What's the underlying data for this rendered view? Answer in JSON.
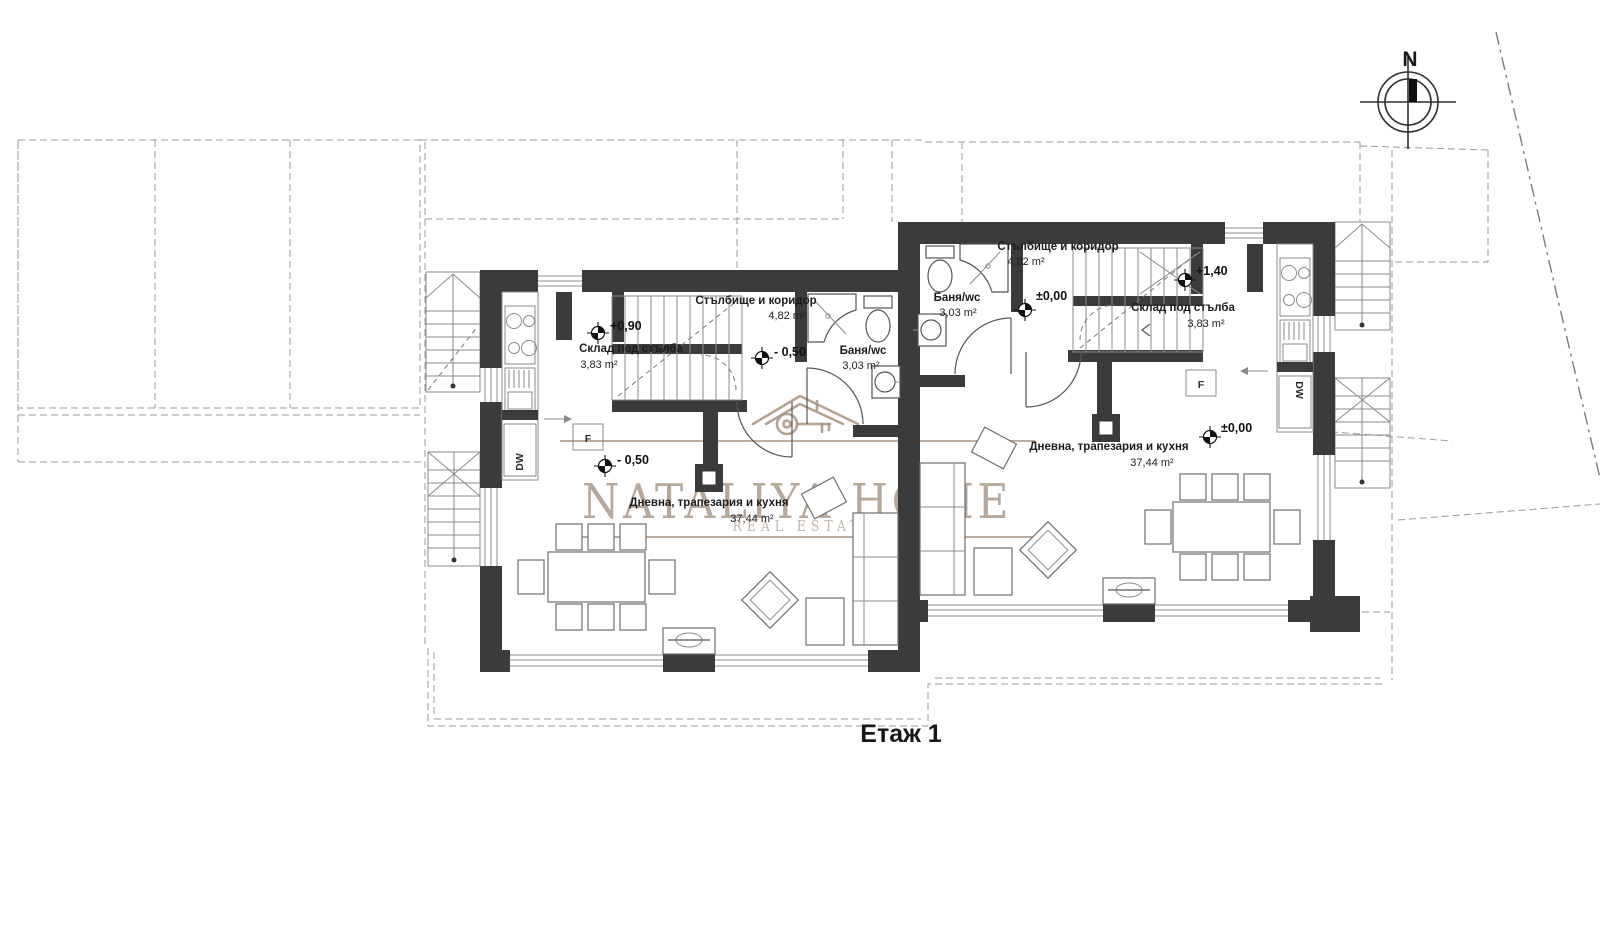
{
  "title": "Етаж 1",
  "compass": {
    "north_label": "N"
  },
  "watermark": {
    "brand": "NATALIYA HOME",
    "tagline": "REAL ESTATE"
  },
  "colors": {
    "wall": "#3b3b3b",
    "watermark": "#b3a597",
    "background": "#ffffff"
  },
  "unit_left": {
    "corridor": {
      "name": "Стълбище и коридор",
      "area": "4,82 m²"
    },
    "storage": {
      "name": "Склад под стълба",
      "area": "3,83 m²"
    },
    "bathroom": {
      "name": "Баня/wc",
      "area": "3,03 m²"
    },
    "living": {
      "name": "Дневна, трапезария и кухня",
      "area": "37,44 m²"
    },
    "levels": {
      "entry": "+0,90",
      "corridor": "- 0,50",
      "living": "- 0,50"
    },
    "appliances": {
      "dishwasher": "DW",
      "fridge": "F"
    }
  },
  "unit_right": {
    "corridor": {
      "name": "Стълбище и коридор",
      "area": "4,82 m²"
    },
    "storage": {
      "name": "Склад под стълба",
      "area": "3,83 m²"
    },
    "bathroom": {
      "name": "Баня/wc",
      "area": "3,03 m²"
    },
    "living": {
      "name": "Дневна, трапезария и кухня",
      "area": "37,44 m²"
    },
    "levels": {
      "corridor": "±0,00",
      "entry": "+1,40",
      "living": "±0,00"
    },
    "appliances": {
      "dishwasher": "DW",
      "fridge": "F"
    }
  }
}
